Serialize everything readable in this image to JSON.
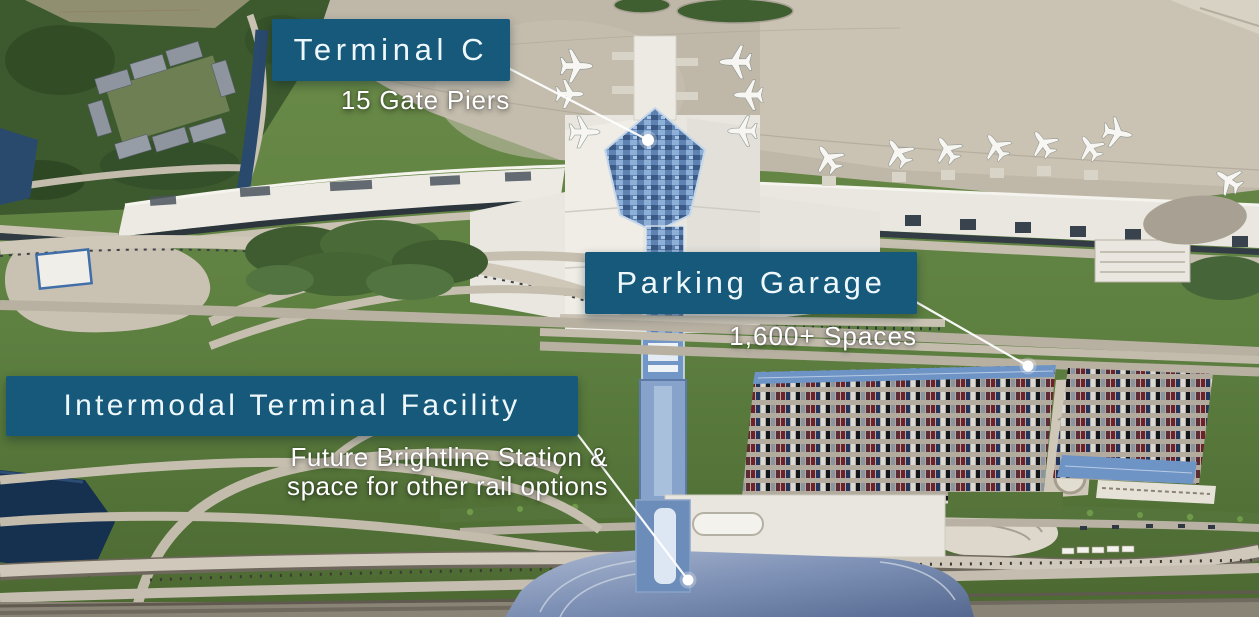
{
  "callouts": {
    "terminal_c": {
      "title": "Terminal C",
      "subtitle": "15 Gate Piers"
    },
    "parking_garage": {
      "title": "Parking Garage",
      "subtitle": "1,600+ Spaces"
    },
    "intermodal_terminal_facility": {
      "title": "Intermodal Terminal Facility",
      "subtitle_line_1": "Future Brightline Station &",
      "subtitle_line_2": "space for other rail options"
    }
  },
  "colors": {
    "label_box": "#16597B",
    "label_text": "#EEF8FC",
    "callout_line": "#FFFFFF",
    "callout_dot": "#FFFFFF"
  }
}
